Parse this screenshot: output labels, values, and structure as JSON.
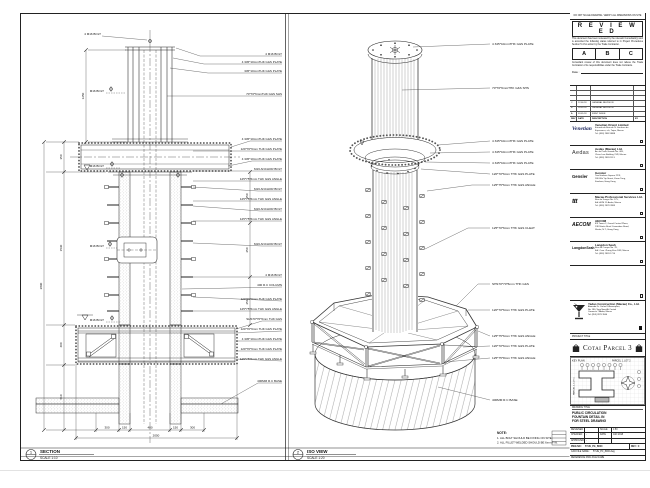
{
  "views": {
    "section": {
      "bubble": "1",
      "title": "SECTION",
      "scale": "SCALE 1:10",
      "labels_right": [
        "4 M16 BOLT",
        "4 345*10mmTHK G&S PLATE",
        "345*10mmTHK G&S PLATE",
        "70*70*6mmTHK G&S SHS",
        "4 345*10mmTHK G&S PLATE",
        "120*70*6mm THK G&S PLATE",
        "4 345*10mmTHK G&S PLATE",
        "M16 ANCHOR BOLT",
        "125*75*6mm THK G&S ANGLE",
        "M16 ANCHOR BOLT",
        "125*75*6mm THK G&S ANGLE",
        "M16 ANCHOR BOLT",
        "125*75*6mm THK G&S ANGLE",
        "M16 ANCHOR BOLT",
        "4 M16 BOLT",
        "400 R.C COLUMN",
        "120*70*6mm THK G&S PLATE",
        "125*75*6mm THK G&S ANGLE",
        "SHS70*70*6mm THK G&S",
        "120*70*6mm THK G&S PLATE",
        "4 345*10mmTHK G&S PLATE",
        "120*70*6mm THK G&S PLATE",
        "125*75*6mm THK G&S ANGLE",
        "400MM R.C BASE"
      ],
      "labels_left": [
        "4 M16 BOLT",
        "M16 BOLT",
        "M16 BOLT",
        "M16 BOLT",
        "M16 BOLT"
      ],
      "dims": {
        "top": "1250",
        "overall": "2890",
        "seg1": "350",
        "seg2": "1530",
        "seg3": "400",
        "seg4": "610",
        "r1": "250",
        "r2": "250",
        "r3": "250",
        "b1": "300",
        "b2": "150",
        "b3": "400",
        "b4": "150",
        "b5": "300",
        "total": "2050"
      }
    },
    "iso": {
      "bubble": "2",
      "title": "ISO VIEW",
      "scale": "SCALE 1:20",
      "labels": [
        "4 345*10mmTHK G&S PLATE",
        "70*70*6mmTHK G&S SHS",
        "4 345*10mmTHK G&S PLATE",
        "4 345*10mmTHK G&S PLATE",
        "4 345*10mmTHK G&S PLATE",
        "120*70*6mm THK G&S PLATE",
        "125*75*6mm THK G&S ANGLE",
        "125*70*6mm THK G&S CLEAT",
        "SHS70*70*6mm THK G&S",
        "120*70*6mm THK G&S PLATE",
        "125*75*6mm THK G&S ANGLE",
        "120*70*6mm THK G&S PLATE",
        "125*75*8mm THK G&S ANGLE",
        "400MM R.C BASE"
      ]
    }
  },
  "notes": {
    "heading": "NOTE:",
    "line1": "1. ALL BOLT SHOULD BE FIXING ON SITE.",
    "line2": "2. ALL FILLET WELDED SHOULD BE 6mm F.W."
  },
  "titleblock": {
    "top_note": "DO NOT SCALE DRAWING. VERIFY ALL DIMENSIONS ON SITE",
    "review": {
      "title": "R E V I E W E D",
      "para1": "This document has been reviewed by the relevant Consultant(s) and is accorded the following status referred to in Project Procedures Section 5.4 for action by the Trade Contractor.",
      "status_a": "A",
      "status_b": "B",
      "status_c": "C",
      "para2": "Consultant review of this document does not relieve the Trade Contractor of its responsibilities under the Trade Contracts.",
      "date_label": "Date :"
    },
    "revisions": {
      "rows": [
        {
          "rev": "C",
          "date": "12.06.18",
          "desc": "GENERAL REVISION",
          "by": ""
        },
        {
          "rev": "B",
          "date": "28.05.18",
          "desc": "GENERAL REVISION",
          "by": ""
        },
        {
          "rev": "A",
          "date": "03.05.18",
          "desc": "FIRST ISSUE",
          "by": ""
        }
      ],
      "header": {
        "rev": "REV",
        "date": "DATE",
        "desc": "DESCRIPTION",
        "by": "BY"
      }
    },
    "consultants": [
      {
        "logo": "Venetian",
        "name": "Venetian Orient Limited",
        "addr1": "Estrada da Baia de N. Senhora da",
        "addr2": "Esperanca, s/n, Taipa, Macau",
        "addr3": "Tel: (853) 2882 8888"
      },
      {
        "logo": "Aedas",
        "name": "Aedas (Macau) Ltd.",
        "addr1": "Av. da Praia Grande No. 409,",
        "addr2": "China Law Building 21/F, Macau",
        "addr3": "Tel: (853) 2833 1113"
      },
      {
        "logo": "Gensler",
        "name": "Gensler",
        "addr1": "Two Harbour Square 22/F,",
        "addr2": "180 Wai Yip Street, Kwun Tong,",
        "addr3": "Kowloon, Hong Kong"
      },
      {
        "logo": "ttt",
        "name": "Macau Professional Services Ltd.",
        "addr1": "Rua de Xangai No. 175,",
        "addr2": "Edf. ACM 11 Andar, Macau",
        "addr3": "Tel: (853) 2878 2883"
      },
      {
        "logo": "AECOM",
        "name": "AECOM",
        "addr1": "8/F Tower 2, Grand Central Plaza,",
        "addr2": "138 Shatin Rural Committee Road,",
        "addr3": "Shatin, N.T., Hong Kong"
      },
      {
        "logo": "LangdonSeah",
        "name": "Langdon Seah",
        "addr1": "Rua do Campo No. 78,",
        "addr2": "Edf. Com. Zhang Kian 18/F, Macau",
        "addr3": "Tel: (853) 2833 1710"
      }
    ],
    "contractor": {
      "name": "Yadao Construction (Macau) Co., Ltd.",
      "addr1": "Alameda Dr. Carlos D'Assumpcao,",
      "addr2": "No. 180, Tong Nam Ah Central",
      "addr3": "Comercio 7 Andar, Macau",
      "addr4": "Tel: (853) 2875 3566"
    },
    "project": {
      "label": "PROJECT TITLE",
      "name": "Cotai Parcel 3"
    },
    "keyplan": {
      "label": "KEY PLAN",
      "parcel_top": "PARCEL 1, LOT 2",
      "parcel_left": "PARCEL 1, LOT 1"
    },
    "drawing": {
      "label": "DRAWING TITLE",
      "line1": "PUBLIC CIRCULATION",
      "line2": "FOUNTAIN DETAIL IN",
      "line3": "FOR STEEL DRAWING",
      "designed_label": "DESIGNED",
      "designed": "",
      "checked_label": "CHECKED",
      "checked": "-",
      "approved_label": "APPROVED",
      "approved": "-",
      "scale_label": "SCALE",
      "scale": "1:50",
      "date_label": "DATE",
      "date": "JAN 2018",
      "dwg_label": "DWG NO :",
      "dwg_no": "5YUE_PG_B000",
      "rev_label": "REV : C",
      "cad_label": "CAD FILE NAME :",
      "cad_file": "5YUE_PC_8000.dwg",
      "ref_label": "REFERENCE DWG FILE NAME"
    }
  }
}
